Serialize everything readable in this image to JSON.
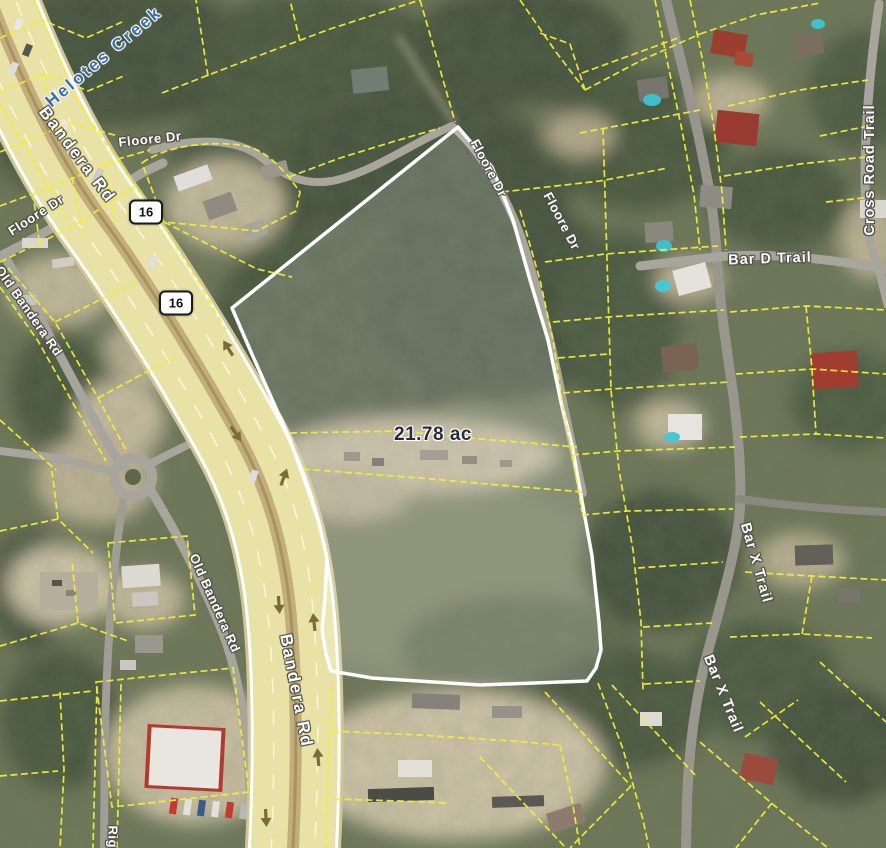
{
  "map": {
    "area_label": "21.78 ac",
    "route_shields": {
      "upper": "16",
      "lower": "16"
    },
    "street_labels": {
      "bandera_rd_upper": "Bandera Rd",
      "bandera_rd_lower": "Bandera Rd",
      "old_bandera_rd_upper": "Old Bandera Rd",
      "old_bandera_rd_lower": "Old Bandera Rd",
      "floore_dr_north": "Floore Dr",
      "floore_dr_west": "Floore Dr",
      "floore_dr_ne_upper": "Floore Dr",
      "floore_dr_ne_lower": "Floore Dr",
      "bar_d_trail": "Bar D Trail",
      "bar_x_trail_upper": "Bar X Trail",
      "bar_x_trail_lower": "Bar X Trail",
      "cross_road_trail": "Cross Road Trail",
      "riggs_rd": "Riggs"
    },
    "water_labels": {
      "helotes_creek": "Helotes Creek"
    },
    "colors": {
      "parcel_line": "#f2ee35",
      "subject_parcel_outline": "#ffffff",
      "subject_parcel_fill": "rgba(255,255,255,0.17)",
      "highway_surface": "#e9e2a6",
      "creek_label": "#3a6fa8",
      "area_label": "#2a2a3c"
    }
  }
}
